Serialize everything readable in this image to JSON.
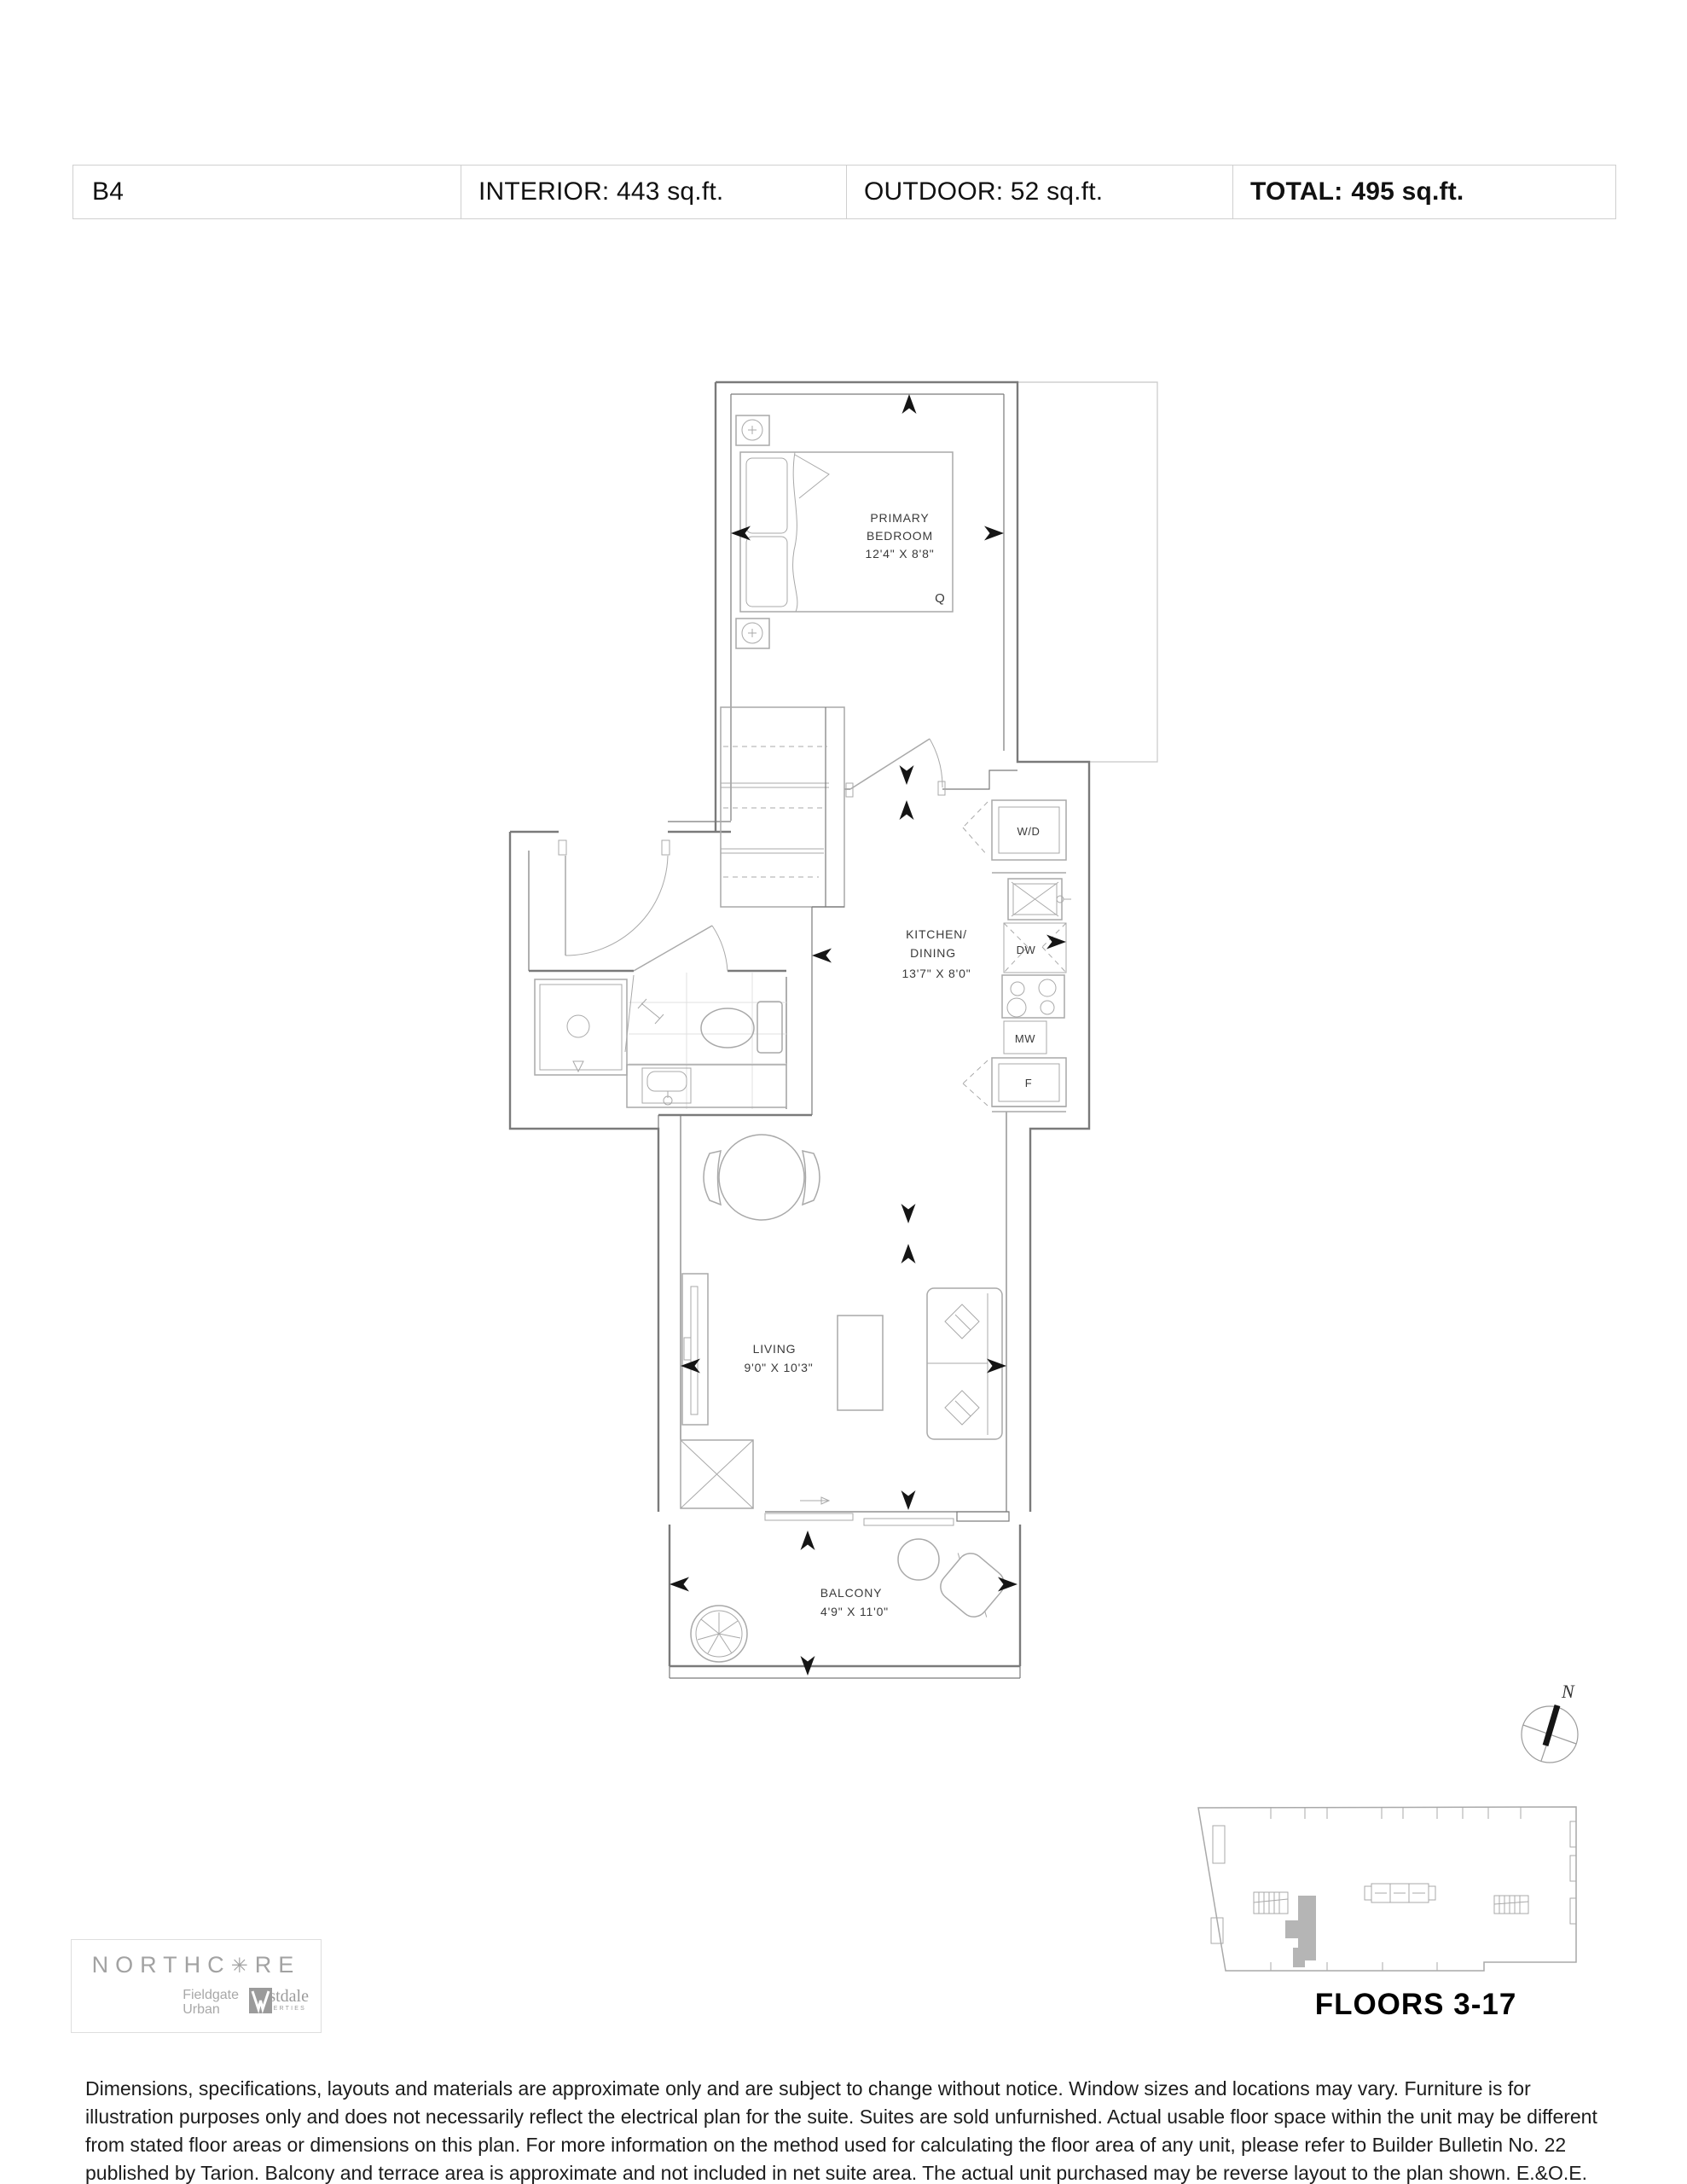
{
  "header": {
    "unit": "B4",
    "interior": "INTERIOR: 443 sq.ft.",
    "outdoor": "OUTDOOR: 52 sq.ft.",
    "total_label": "TOTAL:",
    "total_value": "495 sq.ft."
  },
  "plan": {
    "bedroom": {
      "line1": "PRIMARY",
      "line2": "BEDROOM",
      "dims": "12'4\" X 8'8\"",
      "bed_size": "Q"
    },
    "kitchen": {
      "line1": "KITCHEN/",
      "line2": "DINING",
      "dims": "13'7\" X 8'0\""
    },
    "living": {
      "line1": "LIVING",
      "dims": "9'0\" X 10'3\""
    },
    "balcony": {
      "line1": "BALCONY",
      "dims": "4'9\" X 11'0\""
    },
    "appliances": {
      "washer_dryer": "W/D",
      "dishwasher": "DW",
      "microwave": "MW",
      "fridge": "F"
    }
  },
  "compass": {
    "north": "N"
  },
  "keyplan": {
    "floors": "FLOORS 3-17"
  },
  "logo": {
    "brand_left": "NORTHC",
    "gear": "✳",
    "brand_right": "RE",
    "partner1_line1": "Fieldgate",
    "partner1_line2": "Urban",
    "partner2_name": "westdale",
    "partner2_sub": "PROPERTIES"
  },
  "disclaimer": "Dimensions, specifications, layouts and materials are approximate only and are subject to change without notice. Window sizes and locations may vary. Furniture is for illustration purposes only and does not necessarily reflect the electrical plan for the suite. Suites are sold unfurnished. Actual usable floor space within the unit may be different from stated floor areas or dimensions on this plan. For more information on the method used for calculating the floor area of any unit, please refer to Builder Bulletin No. 22 published by Tarion. Balcony and terrace area is approximate and not included in net suite area. The actual unit purchased may be reverse layout to the plan shown. E.&O.E.",
  "colors": {
    "wall": "#7a7a7a",
    "furniture": "#a9a9a9",
    "label": "#3a3a3a",
    "arrow": "#151515",
    "tile": "#e0e0e0",
    "unit_highlight": "#b5b5b5",
    "logo_gray": "#a2a2a2",
    "border": "#cfcfcf"
  }
}
